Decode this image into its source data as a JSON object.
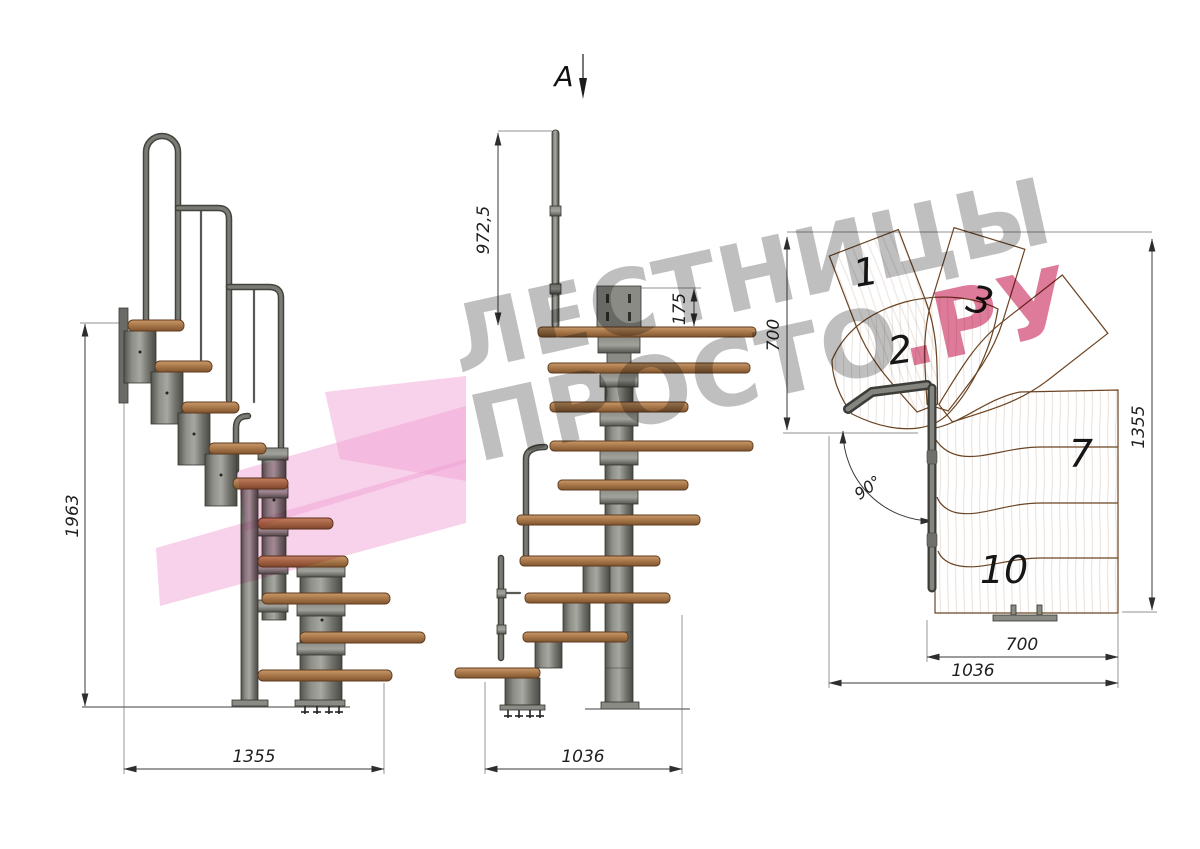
{
  "section_marker": {
    "label": "A"
  },
  "watermark": {
    "line1": "ЛЕСТНИЦЫ",
    "line2_gray": "ПРОСТО",
    "line2_pink": ".РУ",
    "gray": "#8c8c8c",
    "pink": "#cb2a5c"
  },
  "views": {
    "side": {
      "title": "side elevation",
      "dims": {
        "height": "1963",
        "depth": "1355"
      }
    },
    "front": {
      "title": "front elevation",
      "dims": {
        "rail_height": "972,5",
        "plate_offset": "175",
        "depth": "1036"
      }
    },
    "plan": {
      "title": "top plan",
      "dims": {
        "upper_run": "700",
        "overall_depth": "1355",
        "lower_run": "700",
        "overall_width": "1036",
        "turn_angle": "90°"
      },
      "step_numbers": [
        "1",
        "2",
        "3",
        "7",
        "10"
      ]
    }
  },
  "colors": {
    "wood": "#b98551",
    "wood_outline": "#6b4423",
    "metal": "#7a7a75",
    "metal_dark": "#3f3f3a",
    "dim_line": "#3a3a3a",
    "logo_pink": "#f2a3d6"
  }
}
